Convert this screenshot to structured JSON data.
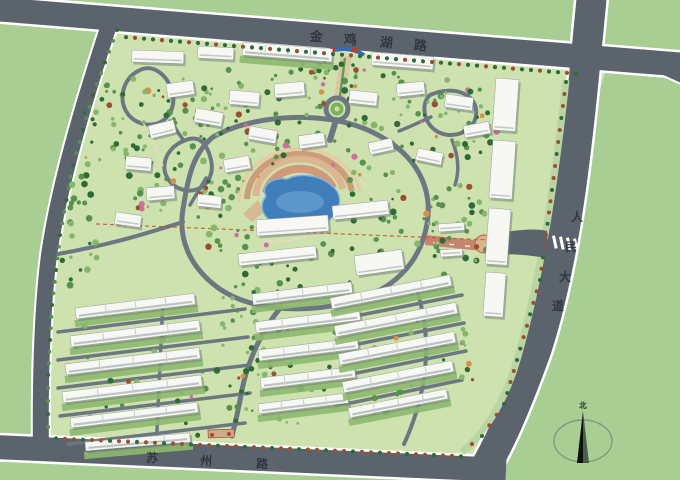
{
  "map": {
    "roads": {
      "top": {
        "label": "金鸡湖路",
        "chars": [
          "金",
          "鸡",
          "湖",
          "路"
        ]
      },
      "right": {
        "label": "人民大道",
        "chars": [
          "人",
          "民",
          "大",
          "道"
        ]
      },
      "bottom": {
        "label": "苏州路",
        "chars": [
          "苏",
          "州",
          "路"
        ]
      }
    },
    "compass": {
      "label": "北"
    },
    "colors": {
      "grass": "#a7cf92",
      "site": "#cde2ae",
      "road": "#5b646d",
      "road_edge": "#ffffff",
      "inner_road": "#6d7781",
      "lake": "#3e7ebd",
      "plaza": "#cf8f70",
      "building": "#f7f7f3",
      "tree_dark": "#2e6b34",
      "tree_mid": "#55924c",
      "tree_light": "#83b868",
      "tree_red": "#9c4f2e",
      "verge": "#b9d5a1",
      "axis_red": "#c9836a",
      "label": "#262d34"
    }
  }
}
